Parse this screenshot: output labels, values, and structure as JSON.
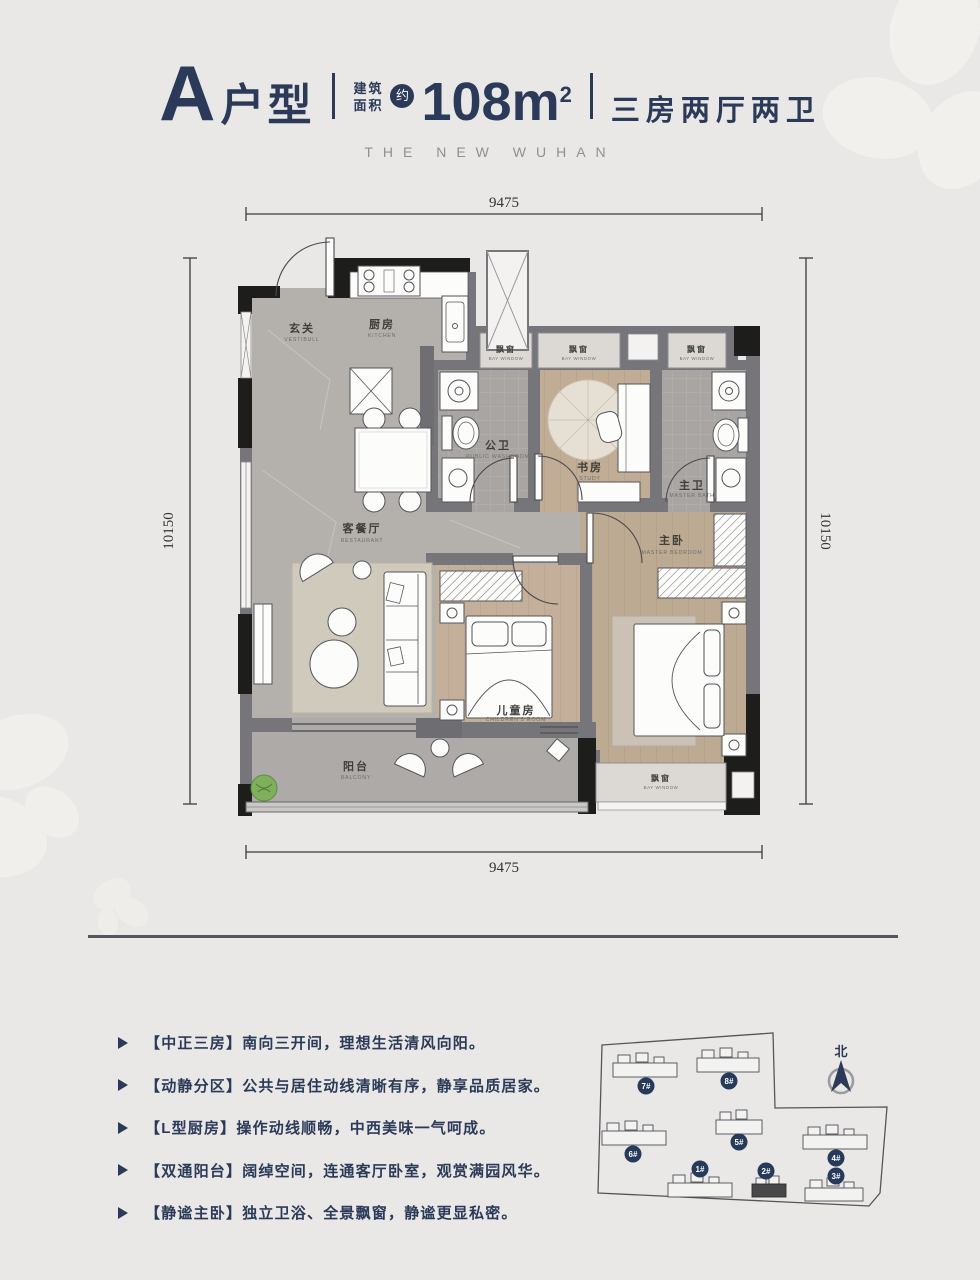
{
  "header": {
    "unit": "A",
    "unit_suffix": "户型",
    "area_prefix_line1": "建筑",
    "area_prefix_line2": "面积",
    "approx_badge": "约",
    "area": "108m",
    "area_sup": "2",
    "layout": "三房两厅两卫",
    "subtitle": "THE NEW WUHAN"
  },
  "plan": {
    "dims": {
      "width": "9475",
      "height": "10150"
    },
    "rooms": [
      {
        "cn": "玄关",
        "en": "VESTIBULL"
      },
      {
        "cn": "厨房",
        "en": "KITCHEN"
      },
      {
        "cn": "公卫",
        "en": "PUBLIC WASHROOM"
      },
      {
        "cn": "书房",
        "en": "STUDY"
      },
      {
        "cn": "主卫",
        "en": "MASTER BATH"
      },
      {
        "cn": "主卧",
        "en": "MASTER BEDROOM"
      },
      {
        "cn": "客餐厅",
        "en": "RESTAURANT"
      },
      {
        "cn": "儿童房",
        "en": "CHILDREN'S ROOM"
      },
      {
        "cn": "阳台",
        "en": "BALCONY"
      }
    ],
    "bay_window": {
      "cn": "飘窗",
      "en": "BAY WINDOW"
    }
  },
  "features": {
    "items": [
      "【中正三房】南向三开间，理想生活清风向阳。",
      "【动静分区】公共与居住动线清晰有序，静享品质居家。",
      "【L型厨房】操作动线顺畅，中西美味一气呵成。",
      "【双通阳台】阔绰空间，连通客厅卧室，观赏满园风华。",
      "【静谧主卧】独立卫浴、全景飘窗，静谧更显私密。"
    ]
  },
  "siteplan": {
    "north_label": "北",
    "buildings": [
      {
        "label": "7#"
      },
      {
        "label": "8#"
      },
      {
        "label": "6#"
      },
      {
        "label": "5#"
      },
      {
        "label": "4#"
      },
      {
        "label": "1#"
      },
      {
        "label": "2#"
      },
      {
        "label": "3#"
      }
    ],
    "highlighted_building": "2#"
  },
  "colors": {
    "background": "#e9e8e6",
    "navy": "#2b3a58",
    "wall_dark": "#1d1d1b",
    "wall_gray": "#76767a",
    "floor_marble": "#b4b0ab",
    "floor_wood": "#c2ae96",
    "floor_tile": "#a9a5a2",
    "bay_window_fill": "#dcd9d5",
    "plant_green": "#7fae5c"
  }
}
